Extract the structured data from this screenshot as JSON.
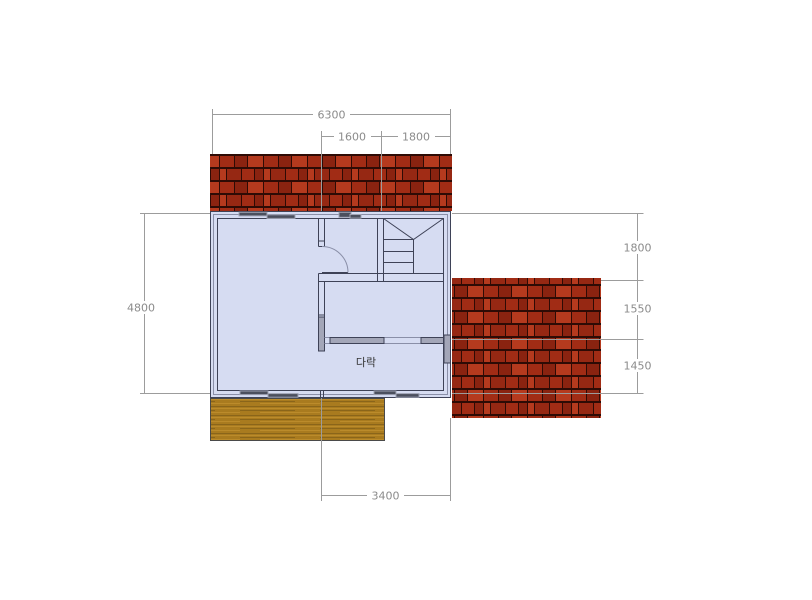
{
  "drawing": {
    "title": "attic-floor-plan",
    "room_label": "다락",
    "dimensions": {
      "overall_width": "6300",
      "stair_bay_left": "1600",
      "stair_bay_right": "1800",
      "overall_depth": "4800",
      "right_depth_top": "1800",
      "right_depth_middle": "1550",
      "right_depth_bottom": "1450",
      "bottom_width": "3400"
    }
  },
  "colors": {
    "bg": "#ffffff",
    "floor": "#d6dcf2",
    "wall": "#3e4257",
    "wallLight": "#8a8fa8",
    "winDark": "#4b4f5e",
    "winMid": "#9fa3b4",
    "grayFill": "#a3a6b8",
    "dim": "#9c9c9c",
    "dimText": "#8b8b8b",
    "label": "#333333",
    "roofGap": "#2e0b05",
    "roofA": "#a12c15",
    "roofB": "#8a2310",
    "roofC": "#b53a1e",
    "roofD": "#962813",
    "deckBase": "#a97b1f",
    "deckDark": "#8a651a",
    "deckLight": "#bb8b2b",
    "deckLine": "#4a4a4a"
  }
}
